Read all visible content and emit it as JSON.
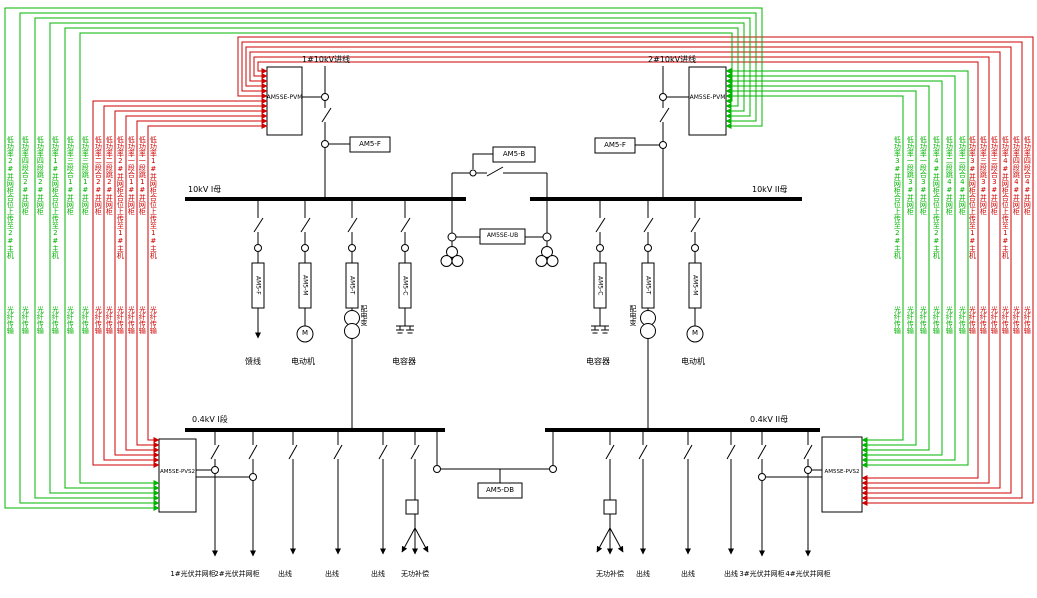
{
  "incoming": {
    "left": "1#10kV进线",
    "right": "2#10kV进线"
  },
  "devices": {
    "pvm": "AM5SE-PVM",
    "f": "AM5-F",
    "b": "AM5-B",
    "ub": "AM5SE-UB",
    "m": "AM5-M",
    "t": "AM5-T",
    "c": "AM5-C",
    "db": "AM5-DB",
    "pvs2": "AM5SE-PVS2"
  },
  "buses": {
    "kv10_1": "10kV I母",
    "kv10_2": "10kV II母",
    "kv04_1": "0.4kV I段",
    "kv04_2": "0.4kV II母"
  },
  "loads": {
    "feeder": "馈线",
    "motor": "电动机",
    "transformer": "配电变",
    "capacitor": "电容器",
    "motor_letter": "M"
  },
  "outgoing": {
    "pv1": "1#光伏并网柜",
    "pv2": "2#光伏并网柜",
    "pv3": "3#光伏并网柜",
    "pv4": "4#光伏并网柜",
    "line": "出线",
    "var_comp": "无功补偿"
  },
  "labels": {
    "fiber": "光纤传输"
  },
  "colors": {
    "green": "#00b400",
    "red": "#cf0000"
  },
  "signals": {
    "left": [
      {
        "color": "green",
        "text": "低功率2#并网柜合位上传至2#主机"
      },
      {
        "color": "green",
        "text": "低功率四段合2#并网柜"
      },
      {
        "color": "green",
        "text": "低功率四段跳2#并网柜"
      },
      {
        "color": "green",
        "text": "低功率1#并网柜合位上传至2#主机"
      },
      {
        "color": "green",
        "text": "低功率三段合1#并网柜"
      },
      {
        "color": "green",
        "text": "低功率三段跳1#并网柜"
      },
      {
        "color": "red",
        "text": "低功率二段合2#并网柜"
      },
      {
        "color": "red",
        "text": "低功率二段跳2#并网柜"
      },
      {
        "color": "red",
        "text": "低功率2#并网柜合位上传至1#主机"
      },
      {
        "color": "red",
        "text": "低功率一段合1#并网柜"
      },
      {
        "color": "red",
        "text": "低功率一段跳1#并网柜"
      },
      {
        "color": "red",
        "text": "低功率1#并网柜合位上传至1#主机"
      }
    ],
    "right": [
      {
        "color": "green",
        "text": "低功率3#并网柜合位上传至2#主机"
      },
      {
        "color": "green",
        "text": "低功率一段跳3#并网柜"
      },
      {
        "color": "green",
        "text": "低功率一段合3#并网柜"
      },
      {
        "color": "green",
        "text": "低功率4#并网柜合位上传至2#主机"
      },
      {
        "color": "green",
        "text": "低功率二段跳4#并网柜"
      },
      {
        "color": "green",
        "text": "低功率二段合4#并网柜"
      },
      {
        "color": "red",
        "text": "低功率3#并网柜合位上传至1#主机"
      },
      {
        "color": "red",
        "text": "低功率三段跳3#并网柜"
      },
      {
        "color": "red",
        "text": "低功率三段合3#并网柜"
      },
      {
        "color": "red",
        "text": "低功率4#并网柜合位上传至1#主机"
      },
      {
        "color": "red",
        "text": "低功率四段跳4#并网柜"
      },
      {
        "color": "red",
        "text": "低功率四段合4#并网柜"
      }
    ]
  }
}
